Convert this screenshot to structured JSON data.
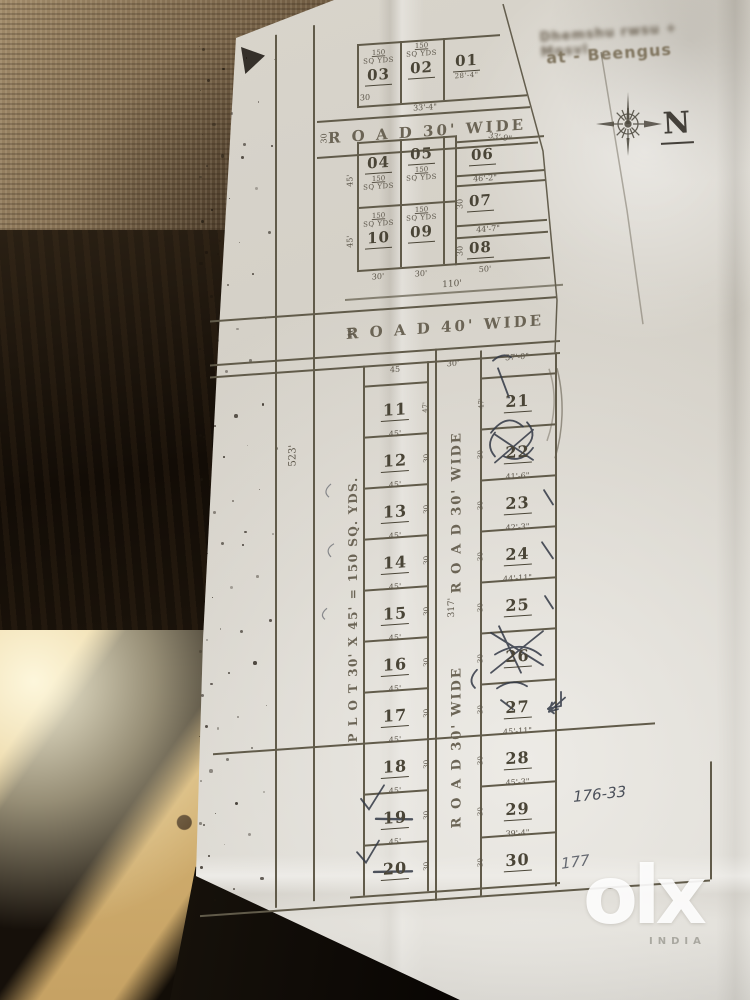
{
  "header": {
    "blurred_line": "Dhemshu rwsu + Mnsvl",
    "location_line": "at - Beengus",
    "compass": "N"
  },
  "top_row": {
    "area": "150",
    "unit": "SQ YDS",
    "plots": [
      "03",
      "02",
      "01"
    ],
    "plot01_dim": "28'-4\"",
    "left_tick": "30",
    "bottom_dim": "33'-4\""
  },
  "road_top": {
    "label": "R O A D 30' WIDE",
    "tick": "30",
    "right_dim": "33'-9\""
  },
  "block_a": {
    "p04": "04",
    "p05": "05",
    "p06": "06",
    "p07": "07",
    "p08": "08",
    "p09": "09",
    "p10": "10",
    "area": "150",
    "unit": "SQ YDS",
    "dim_06": "46'-2\"",
    "dim_07": "44'-7\"",
    "left_dim1": "45'",
    "left_dim2": "45'",
    "tick_07": "30",
    "tick_08": "30",
    "bottom_dim1": "30'",
    "bottom_dim2": "30'",
    "bottom_dim3": "50'"
  },
  "dim_110": "110'",
  "road_40": {
    "label": "R O A D 40' WIDE",
    "tick": "40"
  },
  "main": {
    "top_dims": {
      "d45": "45",
      "d30": "30'",
      "d37": "37'-0\""
    },
    "note_vertical": "P L O T  30' X 45'  =  150  SQ. YDS.",
    "dim_523": "523'",
    "road_label": "R O A D 30' WIDE",
    "dim_317": "317'",
    "left": [
      {
        "no": "11",
        "top": "",
        "side": "47'"
      },
      {
        "no": "12",
        "top": "45'",
        "side": "30"
      },
      {
        "no": "13",
        "top": "45'",
        "side": "30"
      },
      {
        "no": "14",
        "top": "45'",
        "side": "30"
      },
      {
        "no": "15",
        "top": "45'",
        "side": "30"
      },
      {
        "no": "16",
        "top": "45'",
        "side": "30"
      },
      {
        "no": "17",
        "top": "45'",
        "side": "30"
      },
      {
        "no": "18",
        "top": "45'",
        "side": "30"
      },
      {
        "no": "19",
        "top": "45'",
        "side": "30"
      },
      {
        "no": "20",
        "top": "45'",
        "side": "30"
      }
    ],
    "right": [
      {
        "no": "21",
        "top": "",
        "side": "47'"
      },
      {
        "no": "22",
        "top": "",
        "side": "30"
      },
      {
        "no": "23",
        "top": "41'-6\"",
        "side": "30"
      },
      {
        "no": "24",
        "top": "42'-3\"",
        "side": "30"
      },
      {
        "no": "25",
        "top": "44'-11\"",
        "side": "30"
      },
      {
        "no": "26",
        "top": "",
        "side": "30"
      },
      {
        "no": "27",
        "top": "",
        "side": "30"
      },
      {
        "no": "28",
        "top": "45'-11\"",
        "side": "30"
      },
      {
        "no": "29",
        "top": "45'-3\"",
        "side": "30"
      },
      {
        "no": "30",
        "top": "39'-4\"",
        "side": "30"
      }
    ]
  },
  "notes": {
    "survey": "176-33",
    "survey2": "177"
  },
  "watermark": {
    "logo": "olx",
    "country": "INDIA"
  }
}
